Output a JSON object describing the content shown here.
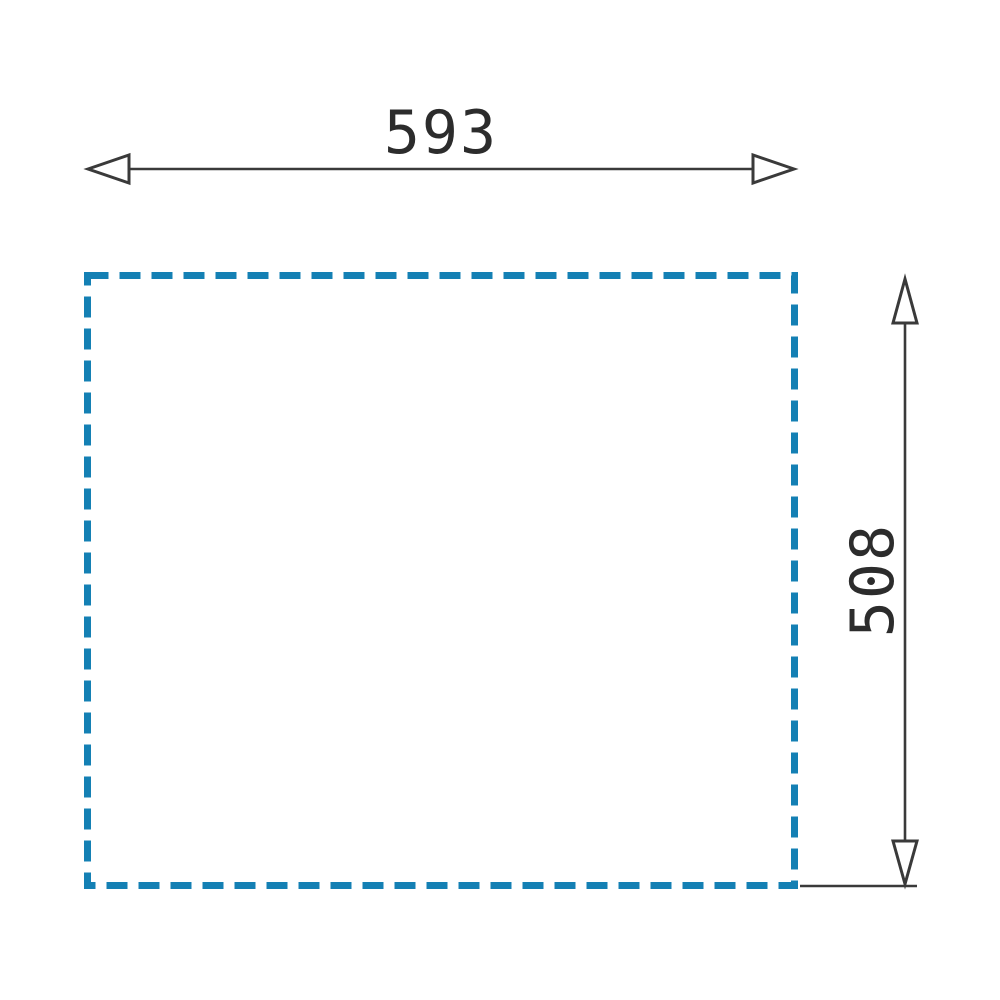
{
  "diagram": {
    "type": "technical-dimension-drawing",
    "description": "Dashed rectangle cutout outline with width and height dimension arrows",
    "width_label": "593",
    "height_label": "508"
  },
  "colors": {
    "dash-blue": "#1480b4",
    "line-dark": "#3a3a3a",
    "text-dark": "#2c2c2c",
    "background": "#ffffff"
  }
}
